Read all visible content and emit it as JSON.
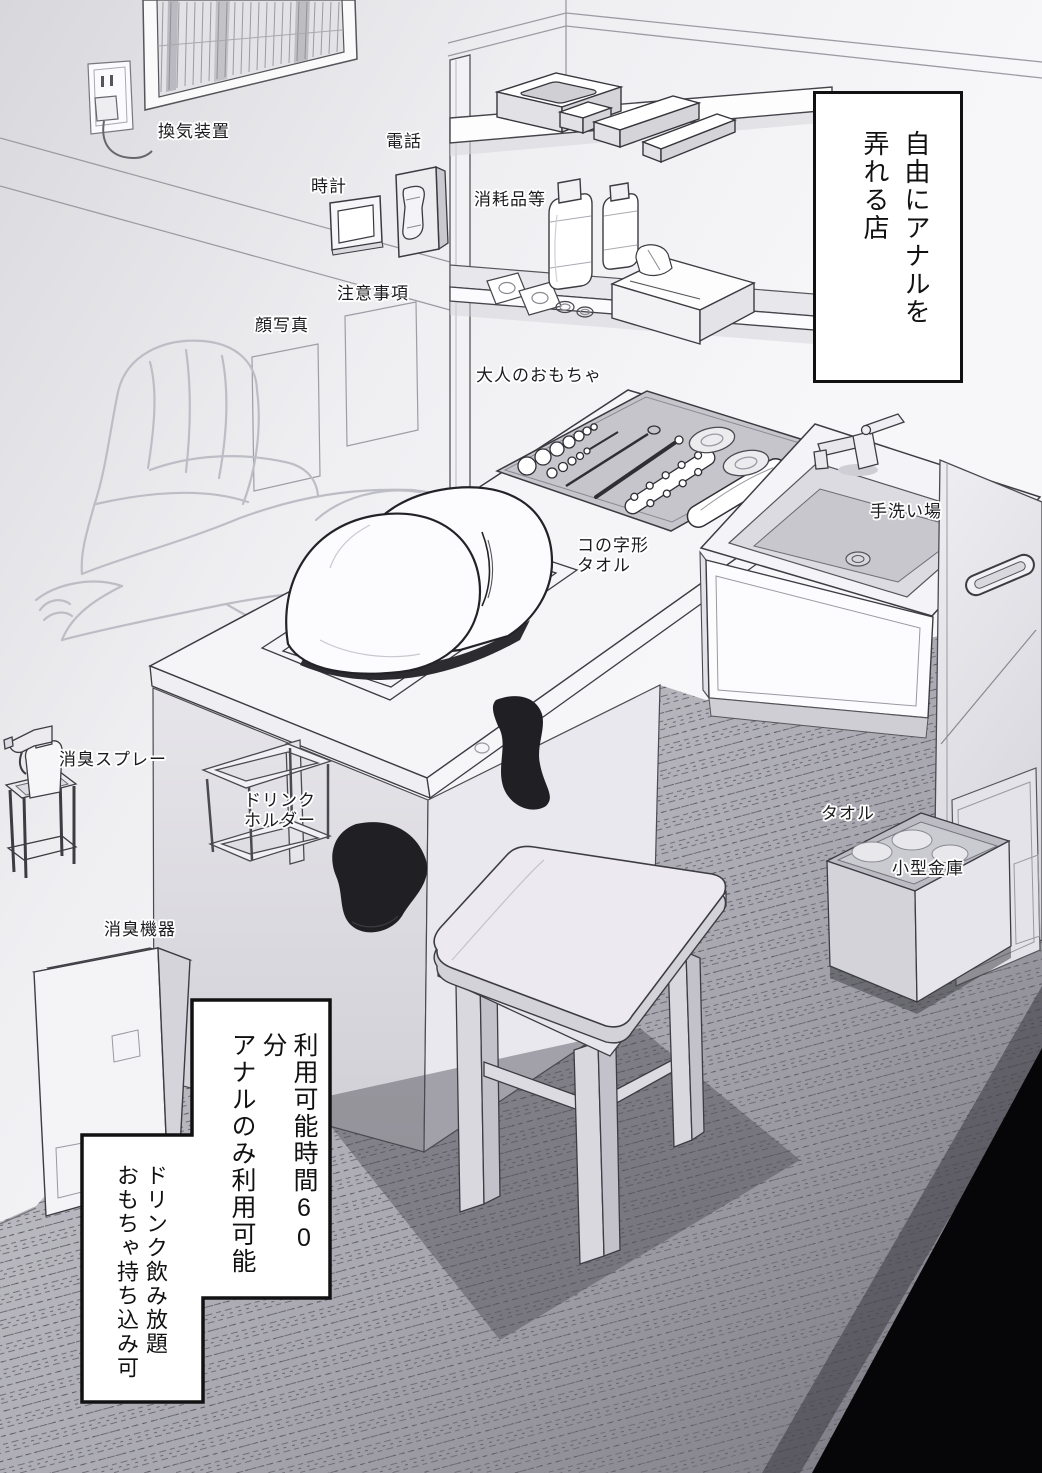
{
  "title_sign": {
    "text": "自由にアナルを\n弄れる店"
  },
  "rules_sign": {
    "box1": "利用可能時間60分\nアナルのみ利用可能",
    "box2": "ドリンク飲み放題\nおもちゃ持ち込み可"
  },
  "labels": {
    "ventilation": "換気装置",
    "phone": "電話",
    "clock": "時計",
    "notice": "注意事項",
    "face_photo": "顔写真",
    "consumables": "消耗品等",
    "adult_toys": "大人のおもちゃ",
    "u_towel": "コの字形\nタオル",
    "hand_wash": "手洗い場",
    "deodorant_spray": "消臭スプレー",
    "drink_holder": "ドリンク\nホルダー",
    "towel": "タオル",
    "small_safe": "小型金庫",
    "deodorizer": "消臭機器"
  },
  "colors": {
    "ink": "#2e2e34",
    "wall_light": "#f6f6f8",
    "wall_dark": "#d7d7db",
    "carpet": "#9a99a1",
    "corner_shadow": "#060608",
    "sign_bg": "#ffffff",
    "sign_border": "#111111",
    "sock": "#202024"
  }
}
